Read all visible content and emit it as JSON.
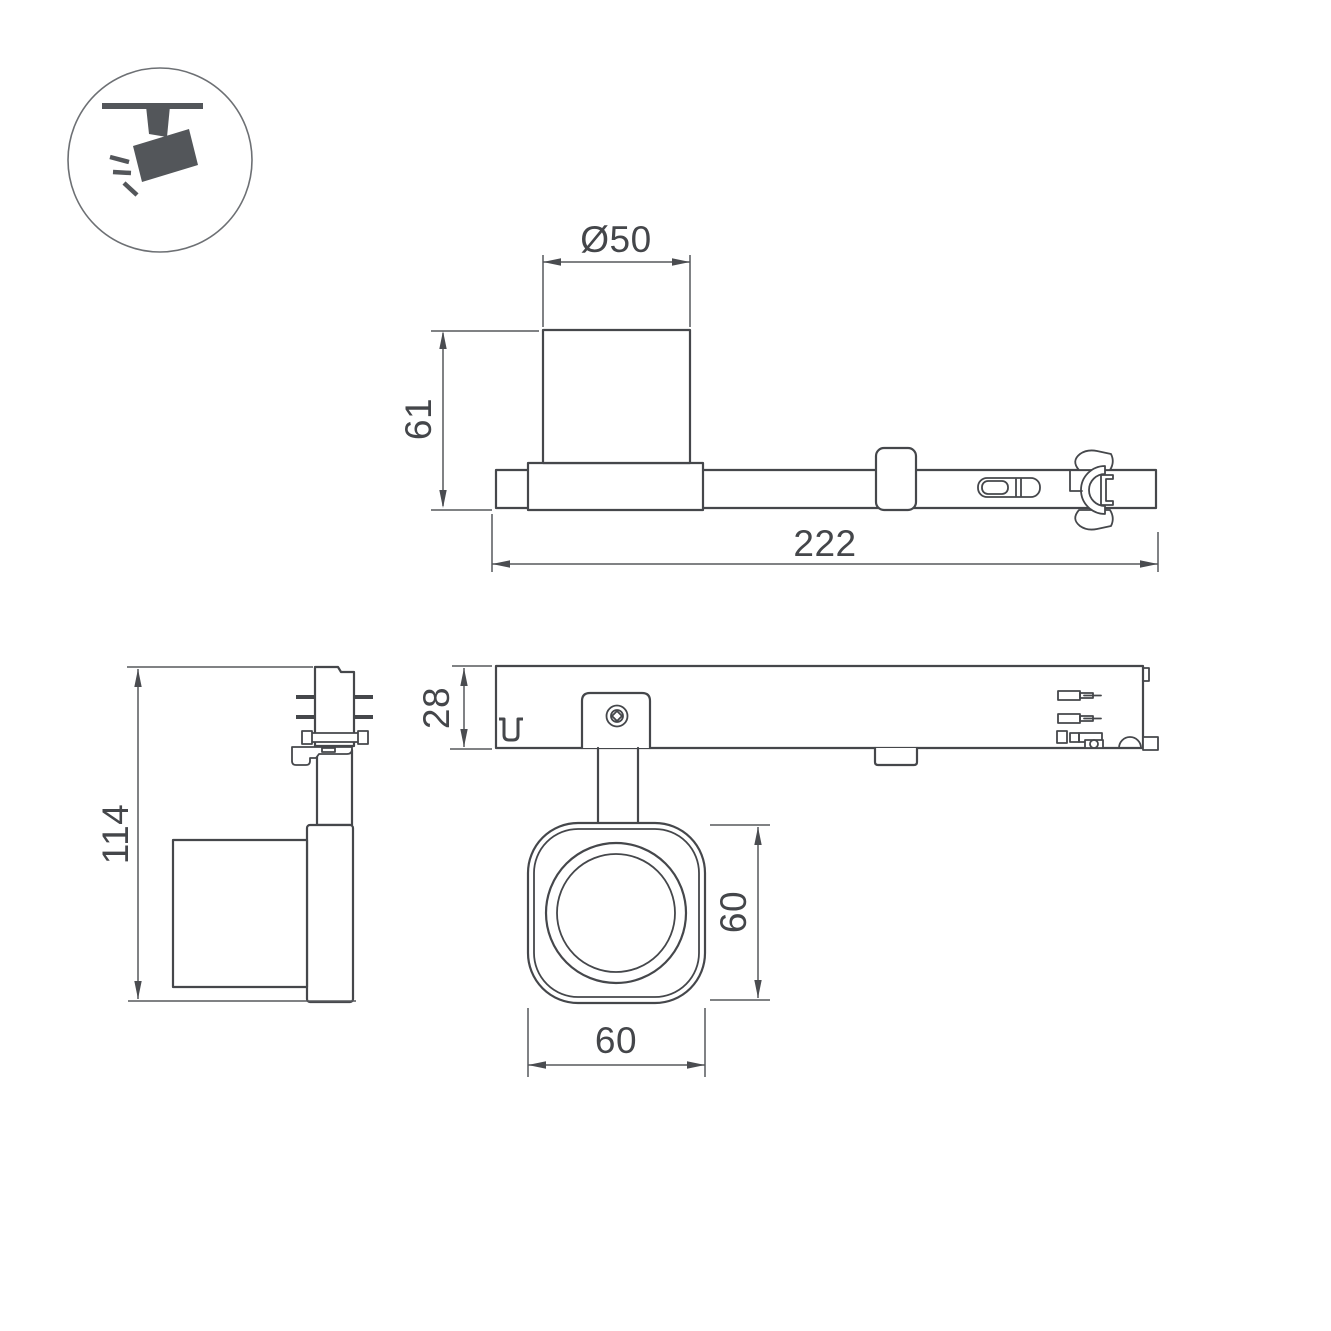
{
  "page": {
    "background": "#ffffff"
  },
  "icon": {
    "name": "track-spotlight-pictogram"
  },
  "dimensions": {
    "head_diameter": "Ø50",
    "body_height": "61",
    "total_length": "222",
    "fixture_height": "114",
    "rail_height": "28",
    "head_height": "60",
    "head_width": "60"
  },
  "colors": {
    "line": "#45474b",
    "dimension": "#56585c",
    "text": "#44464a",
    "icon": "#53565a",
    "background": "#ffffff"
  }
}
